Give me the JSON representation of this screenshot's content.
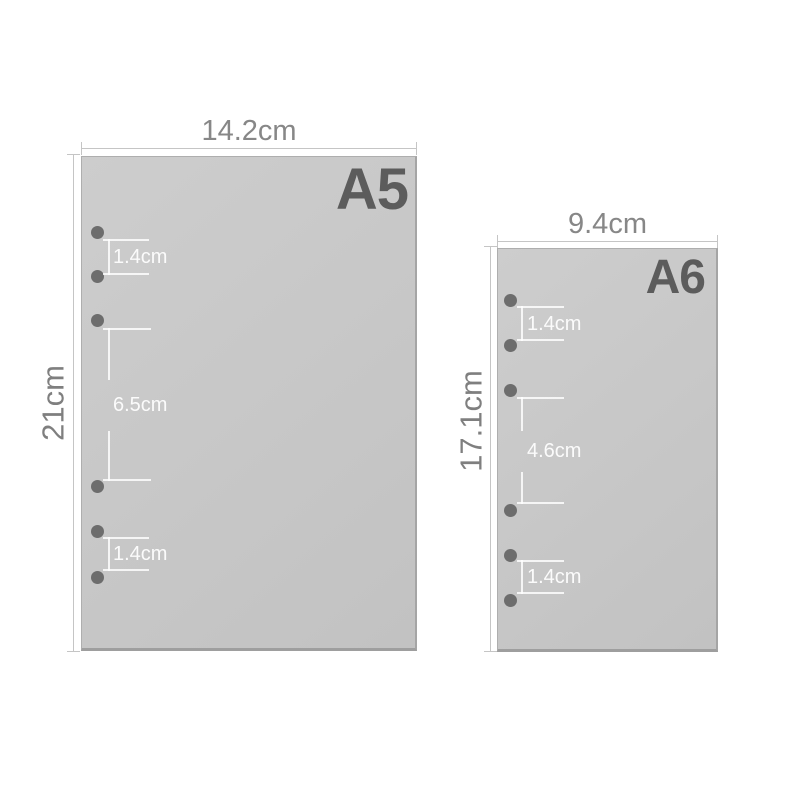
{
  "colors": {
    "background": "#ffffff",
    "sheet_fill": "#c7c7c7",
    "sheet_border": "#a5a5a5",
    "hole": "#6d6d6d",
    "size_label_text": "#5c5c5c",
    "dimension_text": "#878787",
    "dimension_line": "#c5c5c5",
    "inner_measure": "#ffffff"
  },
  "sheets": [
    {
      "name": "A5",
      "width_label": "14.2cm",
      "height_label": "21cm",
      "holes": 6,
      "measures": [
        {
          "label": "1.4cm"
        },
        {
          "label": "6.5cm"
        },
        {
          "label": "1.4cm"
        }
      ]
    },
    {
      "name": "A6",
      "width_label": "9.4cm",
      "height_label": "17.1cm",
      "holes": 6,
      "measures": [
        {
          "label": "1.4cm"
        },
        {
          "label": "4.6cm"
        },
        {
          "label": "1.4cm"
        }
      ]
    }
  ]
}
